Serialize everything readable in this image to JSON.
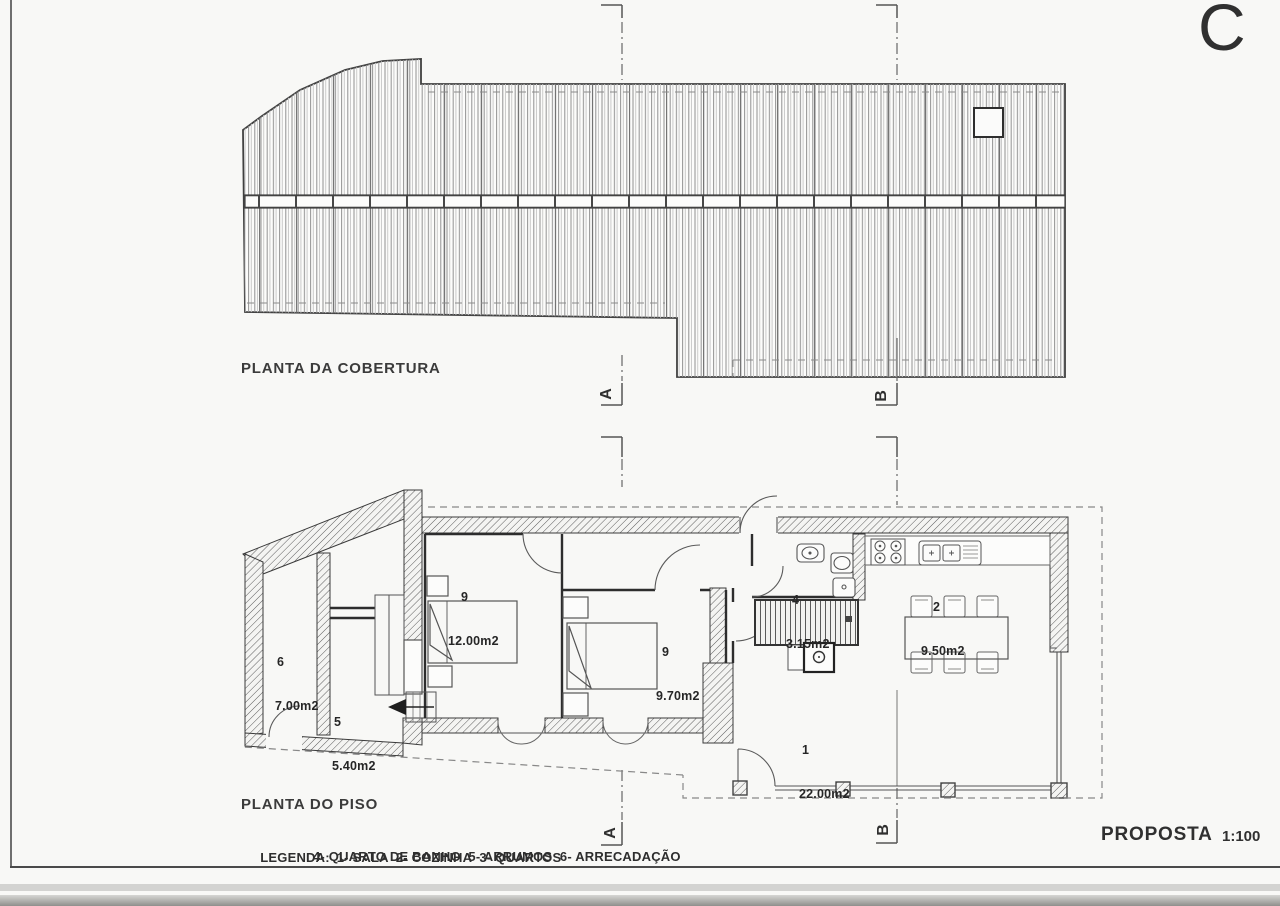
{
  "sheet": {
    "revision_letter": "C",
    "proposal": {
      "label": "PROPOSTA",
      "scale": "1:100"
    }
  },
  "roof_plan": {
    "title": "PLANTA DA COBERTURA"
  },
  "floor_plan": {
    "title": "PLANTA DO PISO",
    "rooms": [
      {
        "id": "living-room",
        "number": "1",
        "area": "22.00m2"
      },
      {
        "id": "kitchen",
        "number": "2",
        "area": "9.50m2"
      },
      {
        "id": "bedroom-large",
        "number": "9",
        "area": "12.00m2"
      },
      {
        "id": "bedroom-small",
        "number": "9",
        "area": "9.70m2"
      },
      {
        "id": "bathroom",
        "number": "4",
        "area": "3.15m2"
      },
      {
        "id": "storage",
        "number": "5",
        "area": "5.40m2"
      },
      {
        "id": "storeroom",
        "number": "6",
        "area": "7.00m2"
      }
    ]
  },
  "section_markers": {
    "a": "A",
    "b": "B"
  },
  "legend": {
    "label": "LEGENDA:",
    "line1": "1- SALA  2- COZINHA  3- QUARTOS",
    "line2": "4- QUARTO DE BANHO  5- ARRUMOS  6- ARRECADAÇÃO"
  }
}
